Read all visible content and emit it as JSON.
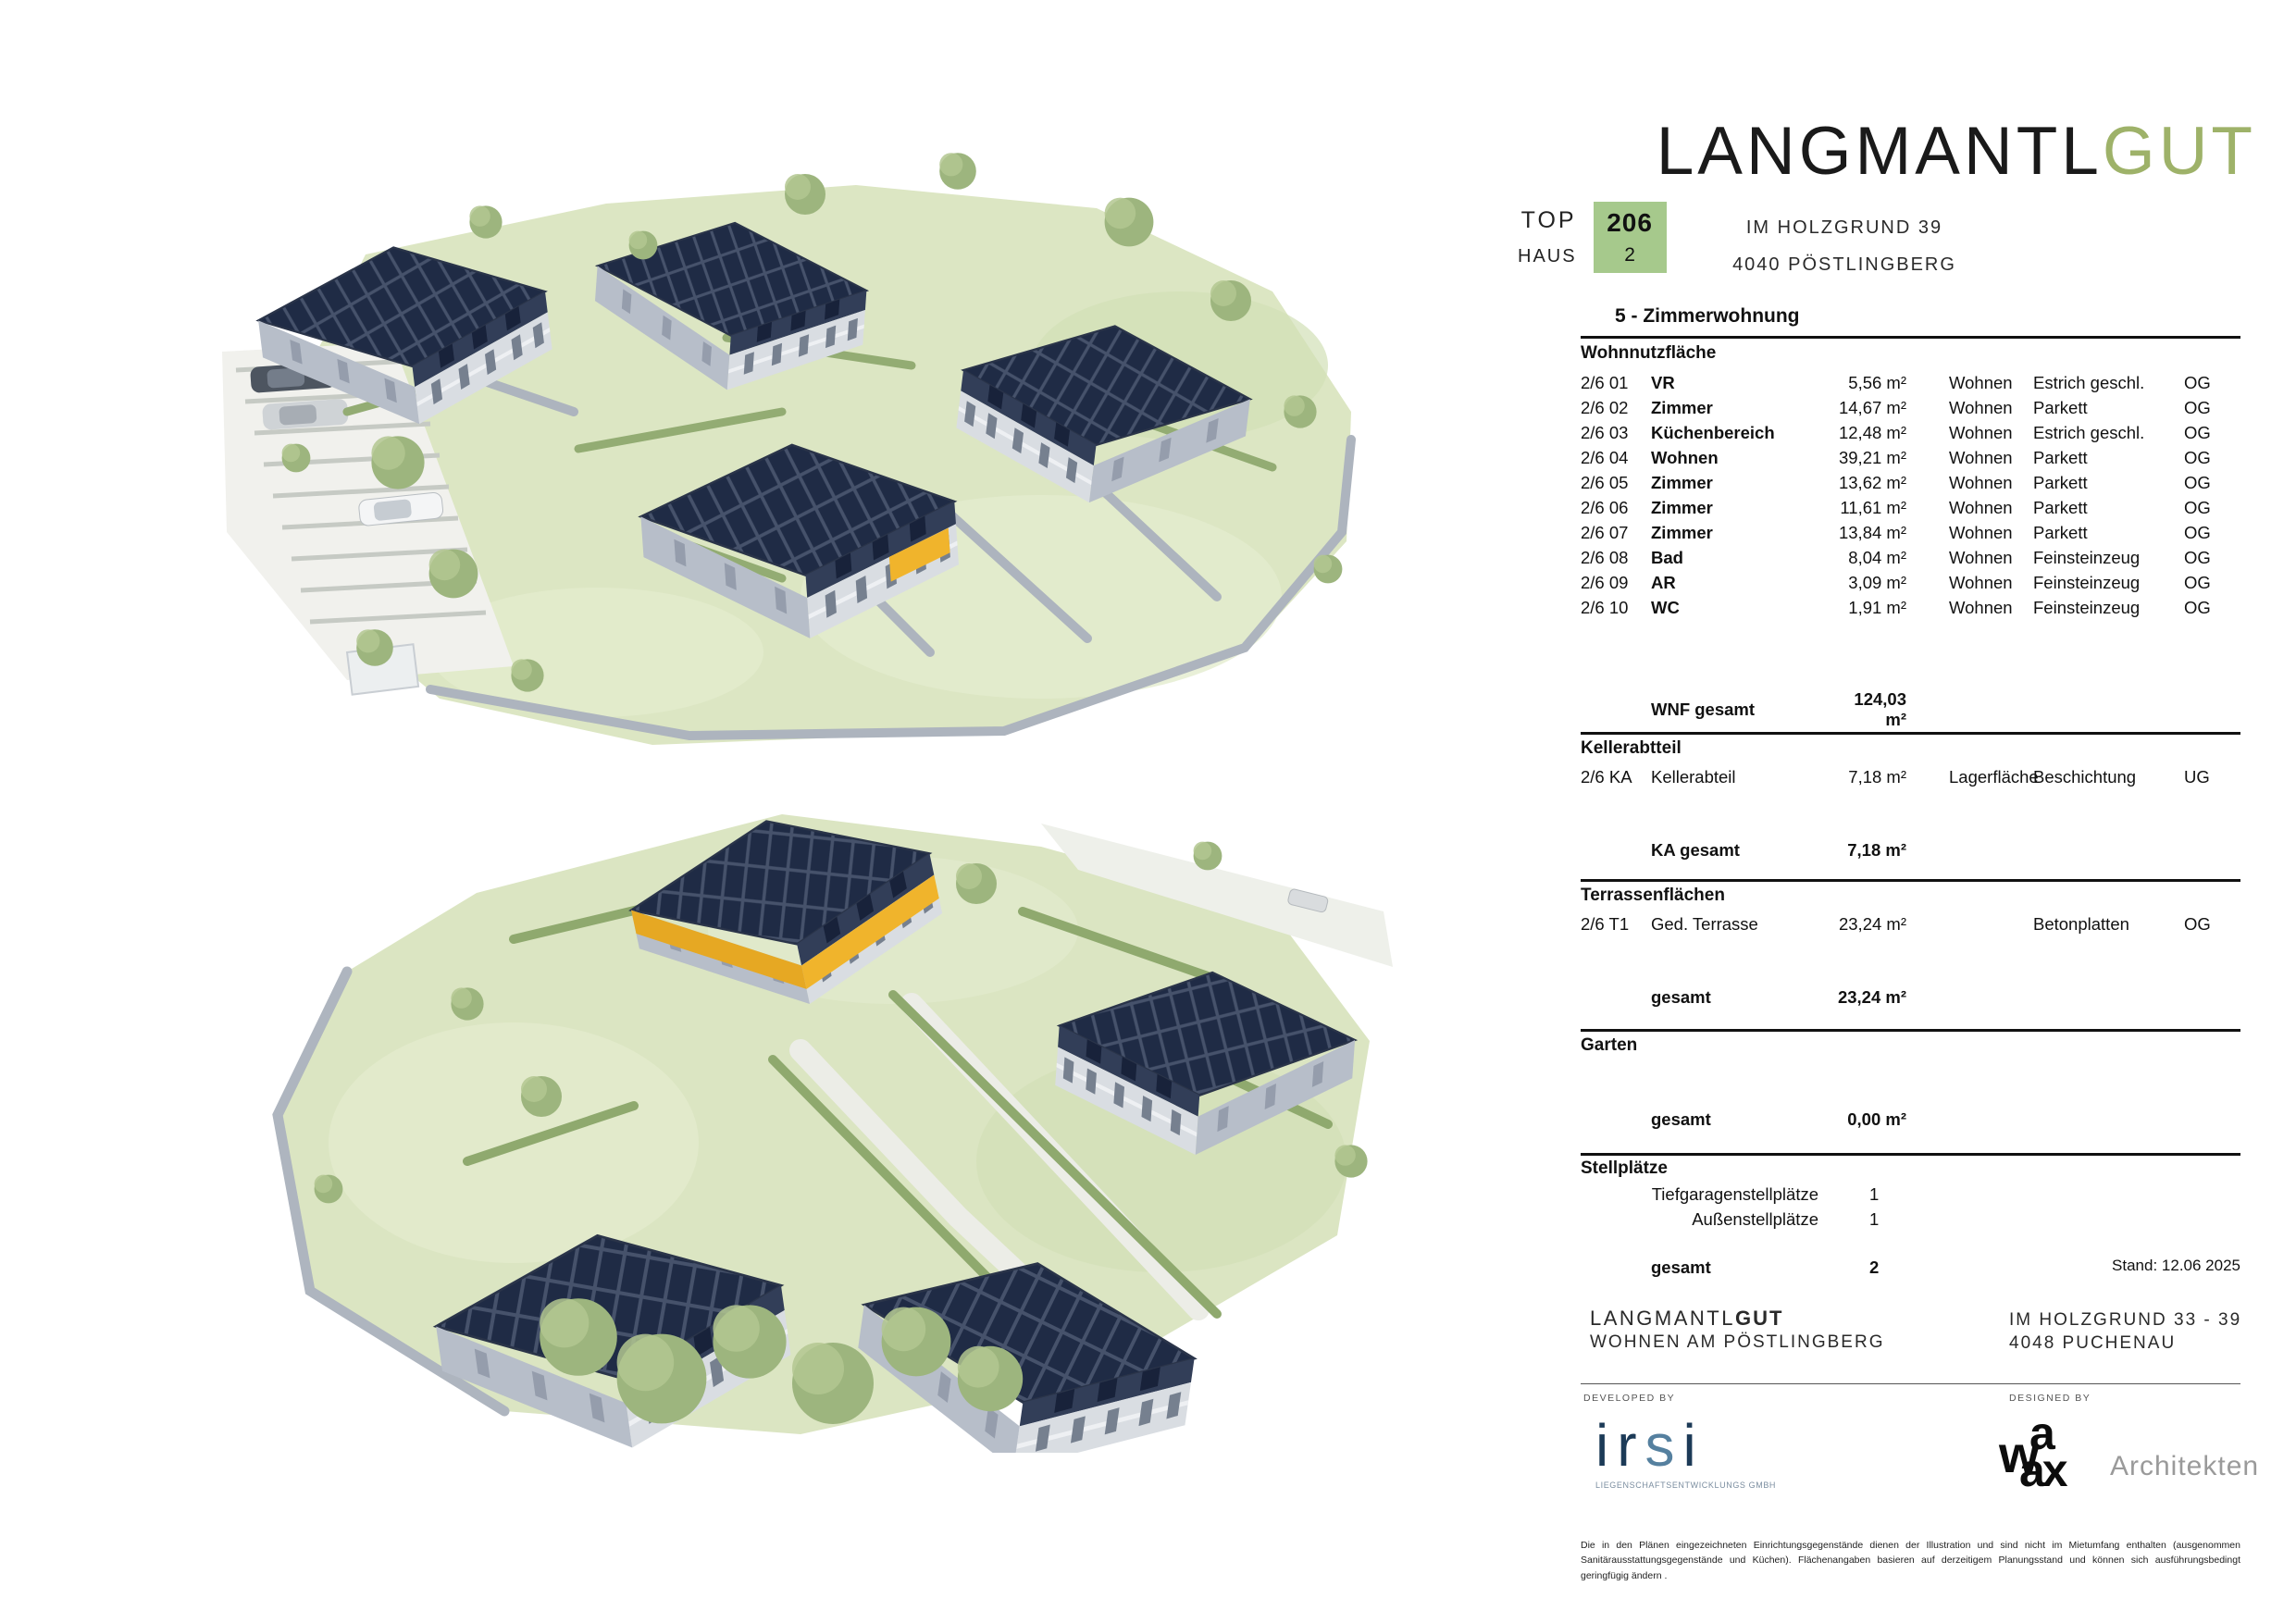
{
  "header": {
    "logo_black": "LANGMANTL",
    "logo_green": "GUT",
    "top_label": "TOP",
    "top_value": "206",
    "haus_label": "HAUS",
    "haus_value": "2",
    "address_line1": "IM HOLZGRUND 39",
    "address_line2": "4040 PÖSTLINGBERG"
  },
  "apartment": {
    "type_title": "5 - Zimmerwohnung"
  },
  "sections": {
    "wohnnutzflaeche": {
      "title": "Wohnnutzfläche",
      "rows": [
        {
          "nr": "2/6 01",
          "name": "VR",
          "area": "5,56 m²",
          "zone": "Wohnen",
          "finish": "Estrich geschl.",
          "floor": "OG"
        },
        {
          "nr": "2/6 02",
          "name": "Zimmer",
          "area": "14,67 m²",
          "zone": "Wohnen",
          "finish": "Parkett",
          "floor": "OG"
        },
        {
          "nr": "2/6 03",
          "name": "Küchenbereich",
          "area": "12,48 m²",
          "zone": "Wohnen",
          "finish": "Estrich geschl.",
          "floor": "OG"
        },
        {
          "nr": "2/6 04",
          "name": "Wohnen",
          "area": "39,21 m²",
          "zone": "Wohnen",
          "finish": "Parkett",
          "floor": "OG"
        },
        {
          "nr": "2/6 05",
          "name": "Zimmer",
          "area": "13,62 m²",
          "zone": "Wohnen",
          "finish": "Parkett",
          "floor": "OG"
        },
        {
          "nr": "2/6 06",
          "name": "Zimmer",
          "area": "11,61 m²",
          "zone": "Wohnen",
          "finish": "Parkett",
          "floor": "OG"
        },
        {
          "nr": "2/6 07",
          "name": "Zimmer",
          "area": "13,84 m²",
          "zone": "Wohnen",
          "finish": "Parkett",
          "floor": "OG"
        },
        {
          "nr": "2/6 08",
          "name": "Bad",
          "area": "8,04 m²",
          "zone": "Wohnen",
          "finish": "Feinsteinzeug",
          "floor": "OG"
        },
        {
          "nr": "2/6 09",
          "name": "AR",
          "area": "3,09 m²",
          "zone": "Wohnen",
          "finish": "Feinsteinzeug",
          "floor": "OG"
        },
        {
          "nr": "2/6 10",
          "name": "WC",
          "area": "1,91 m²",
          "zone": "Wohnen",
          "finish": "Feinsteinzeug",
          "floor": "OG"
        }
      ],
      "total_label": "WNF gesamt",
      "total_value": "124,03 m²"
    },
    "kellerabteil": {
      "title": "Kellerabtteil",
      "rows": [
        {
          "nr": "2/6 KA",
          "name": "Kellerabteil",
          "area": "7,18 m²",
          "zone": "Lagerfläche",
          "finish": "Beschichtung",
          "floor": "UG"
        }
      ],
      "total_label": "KA gesamt",
      "total_value": "7,18 m²"
    },
    "terrassen": {
      "title": "Terrassenflächen",
      "rows": [
        {
          "nr": "2/6 T1",
          "name": "Ged. Terrasse",
          "area": "23,24 m²",
          "zone": "",
          "finish": "Betonplatten",
          "floor": "OG"
        }
      ],
      "total_label": "gesamt",
      "total_value": "23,24 m²"
    },
    "garten": {
      "title": "Garten",
      "total_label": "gesamt",
      "total_value": "0,00 m²"
    },
    "stellplaetze": {
      "title": "Stellplätze",
      "rows": [
        {
          "label": "Tiefgaragenstellplätze",
          "value": "1"
        },
        {
          "label": "Außenstellplätze",
          "value": "1"
        }
      ],
      "total_label": "gesamt",
      "total_value": "2"
    }
  },
  "stand": "Stand: 12.06 2025",
  "footer": {
    "brand_normal": "LANGMANTL",
    "brand_bold": "GUT",
    "brand_sub": "WOHNEN AM PÖSTLINGBERG",
    "address_line1": "IM HOLZGRUND 33 - 39",
    "address_line2": "4048 PUCHENAU",
    "developed_by": "DEVELOPED BY",
    "designed_by": "DESIGNED BY",
    "irsi_name": "irsi",
    "irsi_sub": "LIEGENSCHAFTSENTWICKLUNGS GMBH",
    "waax_w": "w",
    "waax_a": "a",
    "waax_ax": "ax",
    "waax_architekten": "Architekten",
    "disclaimer": "Die in den Plänen eingezeichneten Einrichtungsgegenstände dienen der Illustration und sind nicht im Mietumfang enthalten (ausgenommen Sanitärausstattungsgegenstände und Küchen). Flächenangaben basieren auf derzeitigem Planungsstand und können sich ausführungsbedingt geringfügig ändern ."
  },
  "colors": {
    "accent_yellow": "#F0B42C",
    "brand_green": "#9EB269",
    "unit_box_green": "#A6C98C",
    "irsi_navy": "#1C3A57",
    "irsi_blue": "#55809F"
  }
}
